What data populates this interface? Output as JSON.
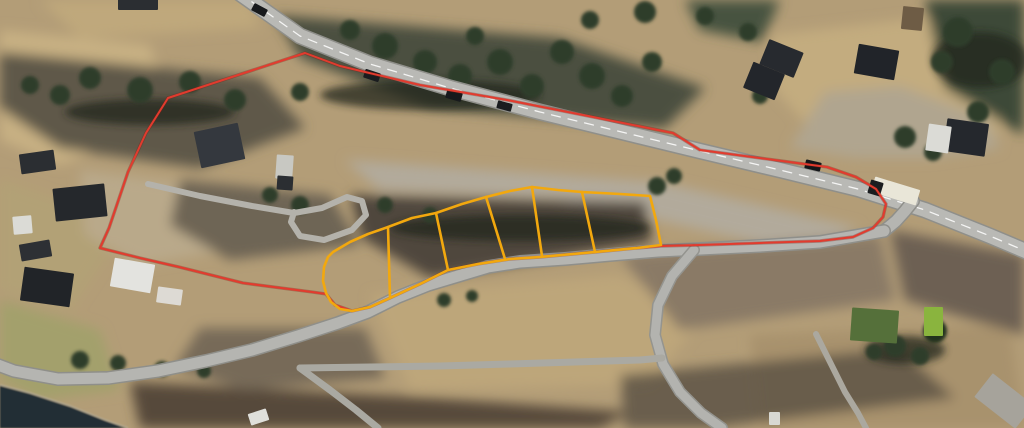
{
  "map": {
    "kind": "aerial-satellite-view",
    "description": "Aerial photo of rural roadside property with red cadastral boundary and six yellow building plots outlined along a road",
    "plot_count": 6,
    "colors": {
      "boundary": "#e23b2e",
      "boundary_halo": "#7e1d12",
      "plots": "#f2a80e",
      "water": "#232d35",
      "road": "#b5b5b1",
      "road_casing": "#8f8f8a",
      "centerline": "#ffffff"
    },
    "boundary": {
      "name": "property-boundary",
      "points": [
        [
          305,
          53
        ],
        [
          168,
          98
        ],
        [
          146,
          133
        ],
        [
          128,
          172
        ],
        [
          109,
          228
        ],
        [
          100,
          248
        ],
        [
          140,
          258
        ],
        [
          179,
          267
        ],
        [
          243,
          283
        ],
        [
          312,
          292
        ],
        [
          326,
          294
        ],
        [
          335,
          305
        ],
        [
          352,
          311
        ],
        [
          370,
          307
        ],
        [
          390,
          298
        ],
        [
          420,
          284
        ],
        [
          448,
          270
        ],
        [
          478,
          264
        ],
        [
          510,
          259
        ],
        [
          540,
          257
        ],
        [
          573,
          254
        ],
        [
          595,
          252
        ],
        [
          637,
          248
        ],
        [
          661,
          246
        ],
        [
          700,
          245
        ],
        [
          760,
          243
        ],
        [
          820,
          241
        ],
        [
          853,
          237
        ],
        [
          873,
          228
        ],
        [
          883,
          217
        ],
        [
          886,
          204
        ],
        [
          876,
          189
        ],
        [
          856,
          177
        ],
        [
          827,
          167
        ],
        [
          767,
          159
        ],
        [
          700,
          150
        ],
        [
          673,
          133
        ],
        [
          593,
          117
        ],
        [
          507,
          100
        ],
        [
          420,
          85
        ],
        [
          340,
          66
        ]
      ]
    },
    "plots": {
      "name": "building-plots",
      "outline": [
        [
          333,
          252
        ],
        [
          350,
          242
        ],
        [
          368,
          234
        ],
        [
          388,
          227
        ],
        [
          412,
          218
        ],
        [
          436,
          213
        ],
        [
          462,
          204
        ],
        [
          486,
          197
        ],
        [
          510,
          191
        ],
        [
          532,
          187
        ],
        [
          558,
          190
        ],
        [
          582,
          192
        ],
        [
          620,
          194
        ],
        [
          650,
          196
        ],
        [
          656,
          220
        ],
        [
          661,
          245
        ],
        [
          637,
          248
        ],
        [
          595,
          252
        ],
        [
          573,
          254
        ],
        [
          540,
          257
        ],
        [
          510,
          259
        ],
        [
          478,
          264
        ],
        [
          448,
          270
        ],
        [
          420,
          284
        ],
        [
          390,
          298
        ],
        [
          370,
          307
        ],
        [
          352,
          311
        ],
        [
          340,
          309
        ],
        [
          331,
          302
        ],
        [
          326,
          293
        ],
        [
          323,
          281
        ],
        [
          324,
          267
        ],
        [
          328,
          257
        ]
      ],
      "dividers": [
        [
          [
            388,
            227
          ],
          [
            390,
            298
          ]
        ],
        [
          [
            436,
            213
          ],
          [
            448,
            270
          ]
        ],
        [
          [
            486,
            197
          ],
          [
            505,
            259
          ]
        ],
        [
          [
            532,
            187
          ],
          [
            542,
            256
          ]
        ],
        [
          [
            582,
            192
          ],
          [
            595,
            252
          ]
        ]
      ]
    },
    "water": {
      "name": "shoreline-water",
      "color": "#232d35",
      "points": [
        [
          0,
          385
        ],
        [
          30,
          393
        ],
        [
          70,
          406
        ],
        [
          105,
          420
        ],
        [
          128,
          428
        ],
        [
          0,
          428
        ]
      ]
    },
    "roads": [
      {
        "name": "highway",
        "width": 14,
        "color": "#b9b9b5",
        "casing": "#8f8f8a",
        "centerline": true,
        "points": [
          [
            238,
            -8
          ],
          [
            300,
            36
          ],
          [
            370,
            64
          ],
          [
            450,
            88
          ],
          [
            540,
            112
          ],
          [
            630,
            134
          ],
          [
            700,
            151
          ],
          [
            780,
            170
          ],
          [
            858,
            189
          ],
          [
            925,
            210
          ],
          [
            990,
            236
          ],
          [
            1035,
            255
          ]
        ]
      },
      {
        "name": "junction-mouth",
        "width": 11,
        "color": "#b5b5b1",
        "casing": "#8f8f8a",
        "points": [
          [
            884,
            231
          ],
          [
            896,
            221
          ],
          [
            905,
            211
          ],
          [
            913,
            201
          ]
        ]
      },
      {
        "name": "side-road-west",
        "width": 11,
        "color": "#b5b5b1",
        "casing": "#8f8f8a",
        "points": [
          [
            884,
            231
          ],
          [
            820,
            242
          ],
          [
            760,
            246
          ],
          [
            700,
            249
          ],
          [
            658,
            251
          ],
          [
            610,
            255
          ],
          [
            565,
            259
          ],
          [
            520,
            262
          ],
          [
            488,
            267
          ],
          [
            458,
            276
          ],
          [
            428,
            285
          ],
          [
            398,
            297
          ],
          [
            368,
            312
          ],
          [
            338,
            323
          ],
          [
            298,
            336
          ],
          [
            252,
            350
          ],
          [
            206,
            361
          ],
          [
            158,
            371
          ],
          [
            108,
            378
          ],
          [
            58,
            379
          ],
          [
            14,
            371
          ],
          [
            -10,
            362
          ]
        ]
      },
      {
        "name": "downhill-road",
        "width": 9,
        "color": "#b3b3af",
        "casing": "#94948f",
        "points": [
          [
            694,
            250
          ],
          [
            672,
            276
          ],
          [
            658,
            305
          ],
          [
            655,
            335
          ],
          [
            663,
            364
          ],
          [
            680,
            392
          ],
          [
            701,
            413
          ],
          [
            722,
            428
          ]
        ]
      },
      {
        "name": "lower-road",
        "width": 7,
        "color": "#aaa9a2",
        "points": [
          [
            300,
            368
          ],
          [
            370,
            367
          ],
          [
            440,
            366
          ],
          [
            510,
            364
          ],
          [
            575,
            362
          ],
          [
            640,
            360
          ],
          [
            662,
            358
          ]
        ]
      },
      {
        "name": "shore-spur",
        "width": 7,
        "color": "#aaa9a2",
        "points": [
          [
            300,
            368
          ],
          [
            330,
            390
          ],
          [
            356,
            410
          ],
          [
            378,
            428
          ]
        ]
      },
      {
        "name": "track-green-house",
        "width": 6,
        "color": "#aba89f",
        "points": [
          [
            816,
            334
          ],
          [
            830,
            362
          ],
          [
            845,
            392
          ],
          [
            858,
            413
          ],
          [
            866,
            428
          ]
        ]
      },
      {
        "name": "driveway-loop",
        "width": 6,
        "color": "#b4b2ab",
        "points": [
          [
            148,
            184
          ],
          [
            200,
            196
          ],
          [
            252,
            206
          ],
          [
            294,
            213
          ],
          [
            322,
            208
          ],
          [
            347,
            197
          ],
          [
            362,
            201
          ],
          [
            366,
            215
          ],
          [
            352,
            230
          ],
          [
            324,
            240
          ],
          [
            300,
            236
          ],
          [
            291,
            222
          ],
          [
            294,
            212
          ]
        ]
      }
    ],
    "buildings": [
      {
        "name": "shed-nw",
        "x": 20,
        "y": 152,
        "w": 35,
        "h": 20,
        "rot": -8,
        "fill": "#2b2e32"
      },
      {
        "name": "farmhouse-left",
        "x": 54,
        "y": 186,
        "w": 52,
        "h": 33,
        "rot": -6,
        "fill": "#25282c"
      },
      {
        "name": "white-shed-left",
        "x": 13,
        "y": 216,
        "w": 19,
        "h": 18,
        "rot": -5,
        "fill": "#dbdbd6"
      },
      {
        "name": "dark-shed-left",
        "x": 20,
        "y": 242,
        "w": 31,
        "h": 17,
        "rot": -10,
        "fill": "#2d3034"
      },
      {
        "name": "farmhouse-sw",
        "x": 22,
        "y": 270,
        "w": 50,
        "h": 34,
        "rot": 8,
        "fill": "#212428"
      },
      {
        "name": "white-barn",
        "x": 112,
        "y": 261,
        "w": 41,
        "h": 29,
        "rot": 10,
        "fill": "#e3e3df"
      },
      {
        "name": "white-shed-s",
        "x": 157,
        "y": 288,
        "w": 25,
        "h": 16,
        "rot": 8,
        "fill": "#dddad4"
      },
      {
        "name": "north-house",
        "x": 197,
        "y": 127,
        "w": 45,
        "h": 37,
        "rot": -12,
        "fill": "#34383e"
      },
      {
        "name": "trailer",
        "x": 276,
        "y": 155,
        "w": 17,
        "h": 24,
        "rot": 4,
        "fill": "#c8c8c2"
      },
      {
        "name": "trailer-dark",
        "x": 277,
        "y": 176,
        "w": 16,
        "h": 14,
        "rot": 4,
        "fill": "#2b2e32"
      },
      {
        "name": "top-edge-building",
        "x": 118,
        "y": -4,
        "w": 40,
        "h": 14,
        "rot": 0,
        "fill": "#2b2e32"
      },
      {
        "name": "house-ne-1",
        "x": 747,
        "y": 67,
        "w": 34,
        "h": 28,
        "rot": 22,
        "fill": "#23262b"
      },
      {
        "name": "house-ne-2",
        "x": 763,
        "y": 45,
        "w": 37,
        "h": 27,
        "rot": 22,
        "fill": "#272a2f"
      },
      {
        "name": "house-ne-3",
        "x": 856,
        "y": 47,
        "w": 41,
        "h": 30,
        "rot": 10,
        "fill": "#212429"
      },
      {
        "name": "frame-shed-ne",
        "x": 902,
        "y": 7,
        "w": 21,
        "h": 23,
        "rot": 6,
        "fill": "#6e5c45"
      },
      {
        "name": "garage-ne-dark",
        "x": 945,
        "y": 121,
        "w": 42,
        "h": 33,
        "rot": 8,
        "fill": "#25282d"
      },
      {
        "name": "garage-ne-white",
        "x": 927,
        "y": 125,
        "w": 23,
        "h": 27,
        "rot": 8,
        "fill": "#dbdbd6"
      },
      {
        "name": "green-house",
        "x": 851,
        "y": 309,
        "w": 47,
        "h": 33,
        "rot": 4,
        "fill": "#55703a"
      },
      {
        "name": "green-house-bright",
        "x": 924,
        "y": 307,
        "w": 19,
        "h": 29,
        "rot": 0,
        "fill": "#8ab43e"
      },
      {
        "name": "boat",
        "x": 249,
        "y": 411,
        "w": 19,
        "h": 12,
        "rot": -18,
        "fill": "#dfdfda"
      },
      {
        "name": "white-object-s",
        "x": 769,
        "y": 412,
        "w": 11,
        "h": 13,
        "rot": 0,
        "fill": "#d8d8d2"
      },
      {
        "name": "gravel-patch-se",
        "x": 978,
        "y": 386,
        "w": 52,
        "h": 30,
        "rot": 38,
        "fill": "#a6a39b"
      }
    ],
    "vehicles": [
      {
        "name": "car",
        "x": 252,
        "y": 6,
        "w": 15,
        "h": 8,
        "rot": 28,
        "fill": "#17191c"
      },
      {
        "name": "car",
        "x": 364,
        "y": 71,
        "w": 16,
        "h": 9,
        "rot": 18,
        "fill": "#1a1c1f"
      },
      {
        "name": "car",
        "x": 446,
        "y": 91,
        "w": 16,
        "h": 9,
        "rot": 16,
        "fill": "#17191c"
      },
      {
        "name": "car",
        "x": 497,
        "y": 102,
        "w": 15,
        "h": 8,
        "rot": 15,
        "fill": "#1a1c1f"
      },
      {
        "name": "car",
        "x": 805,
        "y": 161,
        "w": 16,
        "h": 9,
        "rot": 13,
        "fill": "#141619"
      },
      {
        "name": "bus-body",
        "x": 872,
        "y": 183,
        "w": 47,
        "h": 16,
        "rot": 17,
        "fill": "#e9e6d8"
      },
      {
        "name": "bus-front",
        "x": 869,
        "y": 181,
        "w": 13,
        "h": 14,
        "rot": 17,
        "fill": "#1b1d20"
      }
    ]
  }
}
